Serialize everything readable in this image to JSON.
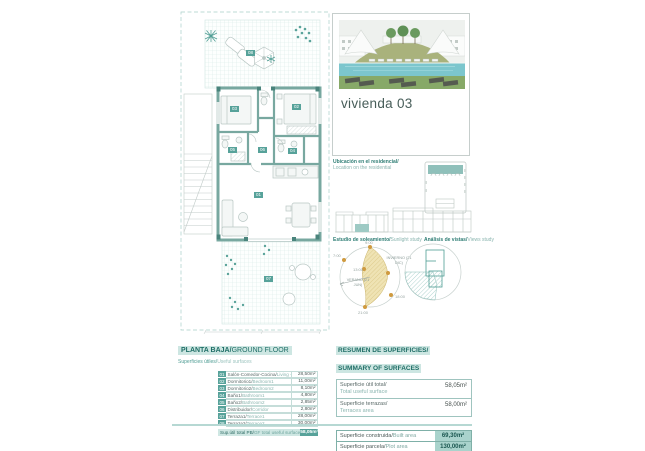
{
  "page": {
    "title": "vivienda 03"
  },
  "colors": {
    "accent_teal": "#57a29a",
    "accent_teal_dark": "#1f6e66",
    "accent_teal_light": "#cde6e2",
    "wall_teal": "#78a8a0",
    "sun_yellow": "#ead9a2",
    "sun_dot_orange": "#cf9a3f",
    "pool_blue": "#7cc6cd",
    "grass_green": "#87a968"
  },
  "location_note": {
    "line_es": "Ubicación en el residencial/",
    "line_en": "Location on the residential"
  },
  "sunlight_study": {
    "caption_es": "Estudio de soleamiento/",
    "caption_en": "Sunlight study",
    "summer_label": "VERANO (21 JUN)",
    "winter_label": "INVIERNO (21 DIC)",
    "hours": [
      "7:00",
      "9:00",
      "13:00",
      "18:00",
      "21:00"
    ]
  },
  "views_study": {
    "caption_es": "Análisis de vistas/",
    "caption_en": "Views study"
  },
  "plan": {
    "chips": {
      "living": "01",
      "bedroom1": "02",
      "bedroom2": "03",
      "bath1": "04",
      "bath2": "05",
      "corridor": "06",
      "terrace1": "07",
      "terrace2": "08"
    }
  },
  "ground_floor": {
    "title_es": "PLANTA BAJA/",
    "title_en": "GROUND FLOOR",
    "subtitle_es": "Superficies útiles/",
    "subtitle_en": "Useful surfaces",
    "rows": [
      {
        "num": "01",
        "label_es": "Salón-Comedor-Cocina/",
        "label_en": "Living - Kitchen",
        "value": "28,50m²"
      },
      {
        "num": "02",
        "label_es": "Dormitorio1/",
        "label_en": "Bedroom1",
        "value": "11,00m²"
      },
      {
        "num": "03",
        "label_es": "Dormitorio2/",
        "label_en": "Bedroom2",
        "value": "8,10m²"
      },
      {
        "num": "04",
        "label_es": "Baño1/",
        "label_en": "Bathroom1",
        "value": "4,80m²"
      },
      {
        "num": "05",
        "label_es": "Baño2/",
        "label_en": "Bathroom2",
        "value": "2,85m²"
      },
      {
        "num": "06",
        "label_es": "Distribuidor/",
        "label_en": "Corridor",
        "value": "2,80m²"
      },
      {
        "num": "07",
        "label_es": "Terraza1/",
        "label_en": "Terrace1",
        "value": "28,00m²"
      },
      {
        "num": "08",
        "label_es": "Terraza2/",
        "label_en": "Terrace2",
        "value": "30,00m²"
      }
    ],
    "total_label_es": "Sup.útil total PB/",
    "total_label_en": "GF total useful surface",
    "total_value": "58,05m²"
  },
  "summary": {
    "title_es": "RESUMEN DE SUPERFICIES/",
    "title_en": "SUMMARY OF SURFACES",
    "rows": [
      {
        "label_es": "Superficie útil total/",
        "label_en": "Total useful surface",
        "value": "58,05m²"
      },
      {
        "label_es": "Superficie terrazas/",
        "label_en": "Terraces area",
        "value": "58,00m²"
      }
    ],
    "totals": [
      {
        "label_es": "Superficie construida/",
        "label_en": "Built area",
        "value": "69,30m²"
      },
      {
        "label_es": "Superficie parcela/",
        "label_en": "Plot area",
        "value": "130,00m²"
      }
    ]
  }
}
